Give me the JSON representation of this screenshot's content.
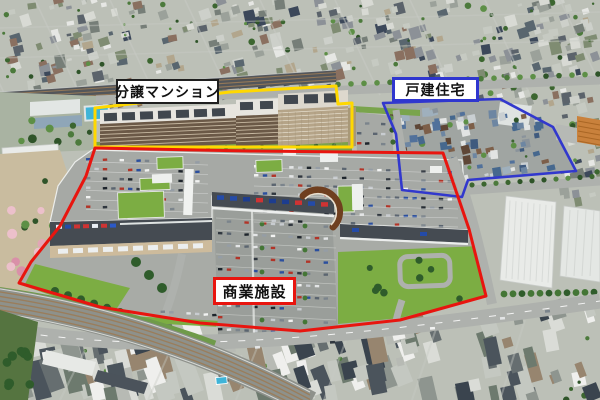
{
  "areas": [
    {
      "id": "condominium",
      "label": "分譲マンション",
      "outline_color": "#ffd800"
    },
    {
      "id": "detached-houses",
      "label": "戸建住宅",
      "outline_color": "#3238cd"
    },
    {
      "id": "commercial-facility",
      "label": "商業施設",
      "outline_color": "#e8150f"
    }
  ],
  "colors": {
    "condominium_outline": "#ffd800",
    "detached_outline": "#3238cd",
    "commercial_outline": "#e8150f",
    "condominium_label_border": "#1f1f1f",
    "detached_label_border": "#2f36cf",
    "commercial_label_border": "#e8150f",
    "label_bg": "#ffffff",
    "label_text": "#111111"
  },
  "scene": {
    "base": "#bcc0b7",
    "deck": "#a6a9a5",
    "deck_light": "#a8aba6",
    "road": "#aeb1ad",
    "street": "#c8cbc5",
    "rail_dark": "#53565a",
    "rail_bed": "#8e918b",
    "rail_tie": "#9b7c58",
    "grass": "#79a44c",
    "lawn": "#7cad43",
    "tree_dark": "#2f5c2b",
    "tree_mid": "#447636",
    "campus_ground": "#a9b3a2",
    "field": "#c9bc9f",
    "pool": "#3fb4d8",
    "apt_roof": "#e7e5df",
    "roof_panel": "#41474e",
    "apt_facade": "#6b5947",
    "apt_window": "#d8cab2",
    "tower_facade": "#b5a488",
    "facade": "#454b52",
    "plaza": "#cdbb9c",
    "curve_brown": "#6f3f1f",
    "white_bldg": "#e9ebe8",
    "orange_bldg": "#c9813c",
    "park": "#557440",
    "cherry": [
      "#e2a6b6",
      "#d990a8",
      "#ecc0cb"
    ],
    "trees": [
      "#4c7a3c",
      "#3c6630",
      "#5d8f46",
      "#2f5429"
    ],
    "signs": [
      "#2b59c9",
      "#1d3d8f",
      "#e9eef5",
      "#244ba8",
      "#cf3333"
    ],
    "cars": [
      "#f2f3f2",
      "#e3e5e6",
      "#30373f",
      "#5b6570",
      "#959da5",
      "#b23428",
      "#2b4f9e",
      "#1d242b",
      "#c8ccd0",
      "#7b848c"
    ],
    "city_roofs": [
      "#d8dad4",
      "#c6cac2",
      "#9ba19a",
      "#767e78",
      "#5b636b",
      "#8c9197",
      "#b2a68d",
      "#e6e7e4",
      "#7f8c72",
      "#3c485a",
      "#8a7060",
      "#59666f",
      "#cdd0ca"
    ],
    "city_south_roofs": [
      "#dadcd7",
      "#c4c8c1",
      "#8e958f",
      "#666e70",
      "#4b545c",
      "#97856f",
      "#b7bab4",
      "#3a444e",
      "#efefed",
      "#6d7a6e"
    ],
    "blue_zone_ground": "#a0a5a2",
    "blue_zone_roofs": [
      "#6d86a2",
      "#51719b",
      "#3f5a7e",
      "#7d5f49",
      "#5e4636",
      "#e2e4e3",
      "#9fb0bd",
      "#8a939b",
      "#46688e",
      "#c9cfd2"
    ]
  }
}
